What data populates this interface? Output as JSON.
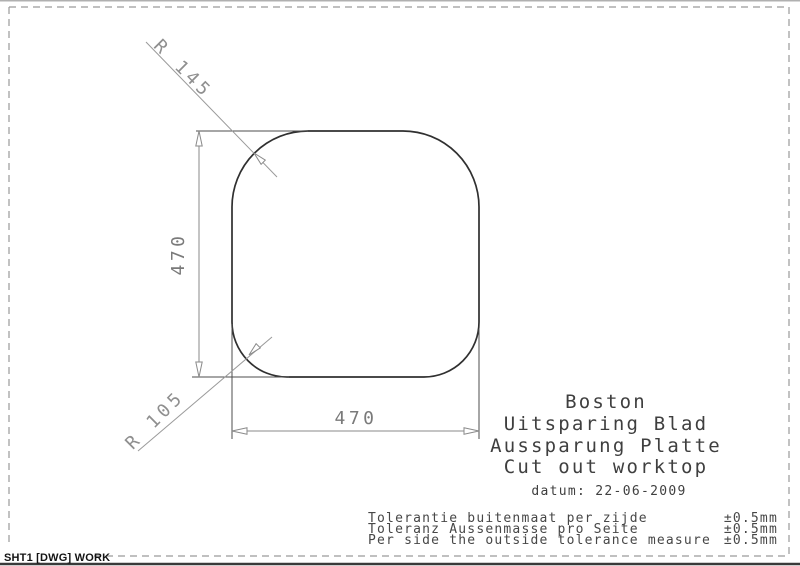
{
  "drawing": {
    "radius_top_label": "R 145",
    "radius_bottom_label": "R 105",
    "height_dim": "470",
    "width_dim": "470"
  },
  "title_block": {
    "lines": [
      "Boston",
      "Uitsparing Blad",
      "Aussparung Platte",
      "Cut out worktop"
    ],
    "datum": "datum: 22-06-2009"
  },
  "tolerances": {
    "rows": [
      {
        "label": "Tolerantie buitenmaat per zijde",
        "value": "±0.5mm"
      },
      {
        "label": "Toleranz Aussenmasse pro Seite",
        "value": "±0.5mm"
      },
      {
        "label": "Per side the outside tolerance measure",
        "value": "±0.5mm"
      }
    ]
  },
  "sheet_tab": {
    "label": "SHT1 [DWG] WORK"
  },
  "colors": {
    "outline": "#303030",
    "dimension": "#8a8a8a",
    "text": "#3f3f3f",
    "background": "#ffffff"
  }
}
